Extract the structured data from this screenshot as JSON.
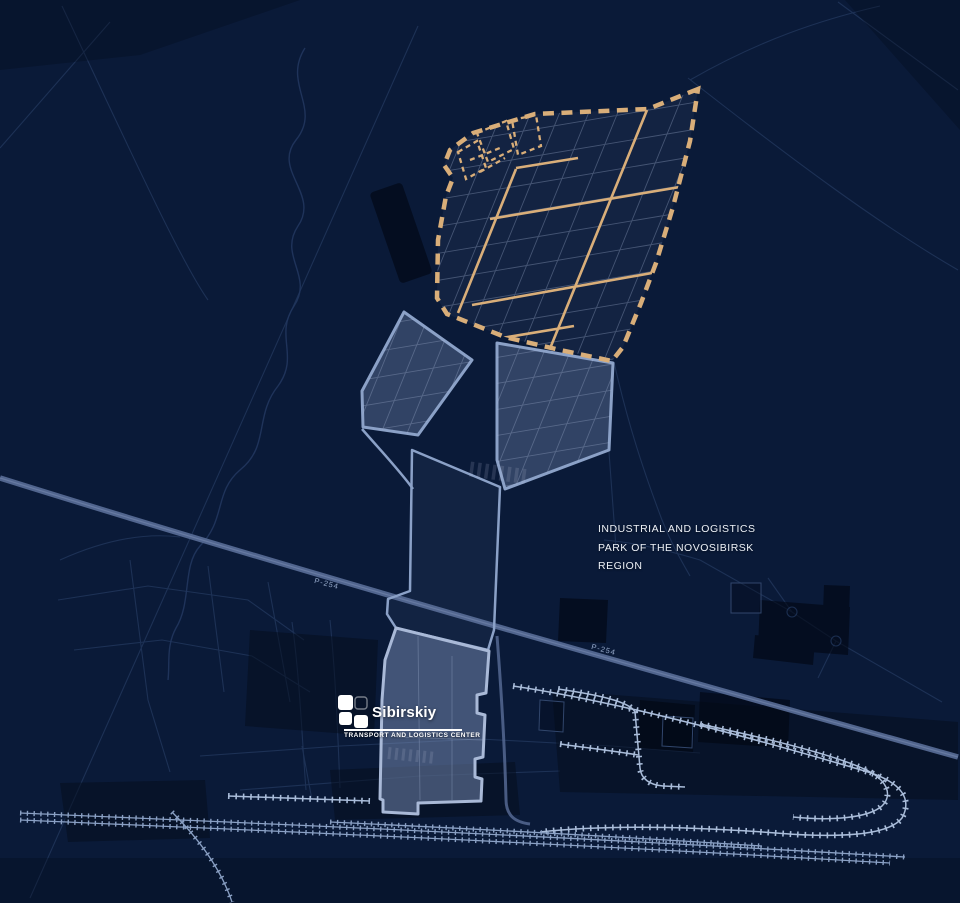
{
  "colors": {
    "bg": "#0a1a38",
    "line": "#22375d",
    "river": "#21365e",
    "dash": "#d9ae79",
    "dash-fill": "rgba(130,150,188,0.08)",
    "grid": "rgba(150,165,198,0.38)",
    "area-fill": "rgba(112,134,176,0.38)",
    "area-stroke": "#8ba1c7",
    "parcel": "rgba(168,183,214,0.32)",
    "site-fill": "rgba(128,148,188,0.48)",
    "site-stroke": "#a9b9d7",
    "road": "#556992",
    "road-edge": "#8295ba",
    "rail": "#a9bcd9",
    "rail-dim": "#8aa0c4",
    "text": "#eef2f8",
    "label": "#96a9ca",
    "logo": "#ffffff"
  },
  "title": {
    "line1": "INDUSTRIAL AND LOGISTICS",
    "line2": "PARK OF THE NOVOSIBIRSK",
    "line3": "REGION"
  },
  "logo": {
    "name": "Sibirskiy",
    "subtitle": "TRANSPORT AND LOGISTICS CENTER"
  },
  "road_labels": {
    "first": "P-254",
    "second": "P-254"
  }
}
